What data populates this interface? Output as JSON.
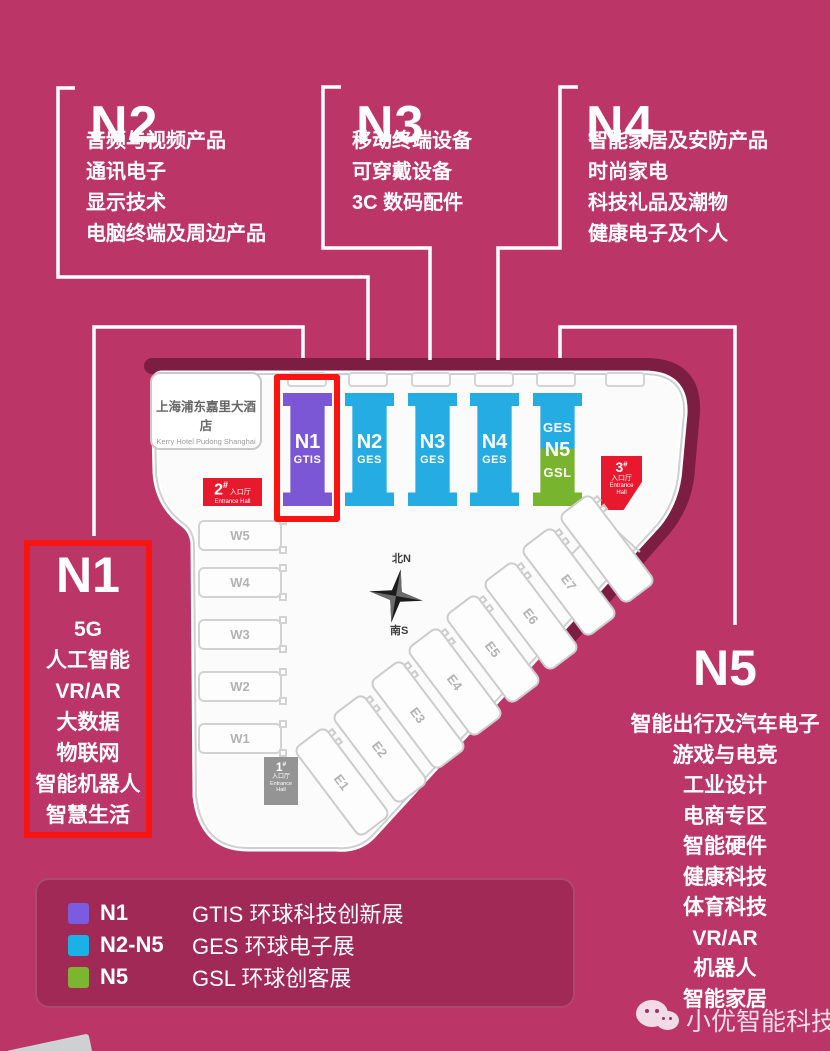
{
  "colors": {
    "background": "#bb3566",
    "legend_panel": "#a12955",
    "highlight_red": "#f81410",
    "entrance_red": "#e8192e",
    "entrance_grey": "#949494",
    "hall_purple": "#7b57d6",
    "hall_blue": "#25ace2",
    "hall_green": "#79b42e",
    "legend_purple": "#7b5be0",
    "legend_blue": "#19b1e6",
    "legend_green": "#7cb52f"
  },
  "callouts": {
    "n2": {
      "title": "N2",
      "items": [
        "音频与视频产品",
        "通讯电子",
        "显示技术",
        "电脑终端及周边产品"
      ]
    },
    "n3": {
      "title": "N3",
      "items": [
        "移动终端设备",
        "可穿戴设备",
        "3C 数码配件"
      ]
    },
    "n4": {
      "title": "N4",
      "items": [
        "智能家居及安防产品",
        "时尚家电",
        "科技礼品及潮物",
        "健康电子及个人"
      ]
    },
    "n1": {
      "title": "N1",
      "items": [
        "5G",
        "人工智能",
        "VR/AR",
        "大数据",
        "物联网",
        "智能机器人",
        "智慧生活"
      ]
    },
    "n5": {
      "title": "N5",
      "items": [
        "智能出行及汽车电子",
        "游戏与电竞",
        "工业设计",
        "电商专区",
        "智能硬件",
        "健康科技",
        "体育科技",
        "VR/AR",
        "机器人",
        "智能家居"
      ]
    }
  },
  "map": {
    "hotel": {
      "name_cn": "上海浦东嘉里大酒店",
      "name_en": "Kerry Hotel Pudong Shanghai"
    },
    "halls": [
      {
        "id": "n1",
        "label": "N1",
        "sublabel": "GTIS",
        "scheme": "purple",
        "highlighted": true
      },
      {
        "id": "n2",
        "label": "N2",
        "sublabel": "GES",
        "scheme": "blue",
        "highlighted": false
      },
      {
        "id": "n3",
        "label": "N3",
        "sublabel": "GES",
        "scheme": "blue",
        "highlighted": false
      },
      {
        "id": "n4",
        "label": "N4",
        "sublabel": "GES",
        "scheme": "blue",
        "highlighted": false
      },
      {
        "id": "n5",
        "label": "N5",
        "top_label": "GES",
        "bottom_label": "GSL",
        "scheme": "split",
        "highlighted": false
      }
    ],
    "west_halls": [
      "W5",
      "W4",
      "W3",
      "W2",
      "W1"
    ],
    "east_halls": [
      "E1",
      "E2",
      "E3",
      "E4",
      "E5",
      "E6",
      "E7",
      ""
    ],
    "entrances": [
      {
        "num": "1",
        "suffix": "#",
        "cn": "入口厅",
        "en": "Entrance Hall"
      },
      {
        "num": "2",
        "suffix": "#",
        "cn": "入口厅",
        "en": "Entrance Hall"
      },
      {
        "num": "3",
        "suffix": "#",
        "cn": "入口厅",
        "en": "Entrance Hall"
      }
    ],
    "compass": {
      "north": "北N",
      "south": "南S"
    }
  },
  "legend": {
    "rows": [
      {
        "color": "#7b5be0",
        "label": "N1",
        "desc": "GTIS 环球科技创新展"
      },
      {
        "color": "#19b1e6",
        "label": "N2-N5",
        "desc": "GES 环球电子展"
      },
      {
        "color": "#7cb52f",
        "label": "N5",
        "desc": "GSL 环球创客展"
      }
    ]
  },
  "watermark": {
    "text": "小优智能科技",
    "icon": "wechat-icon"
  }
}
